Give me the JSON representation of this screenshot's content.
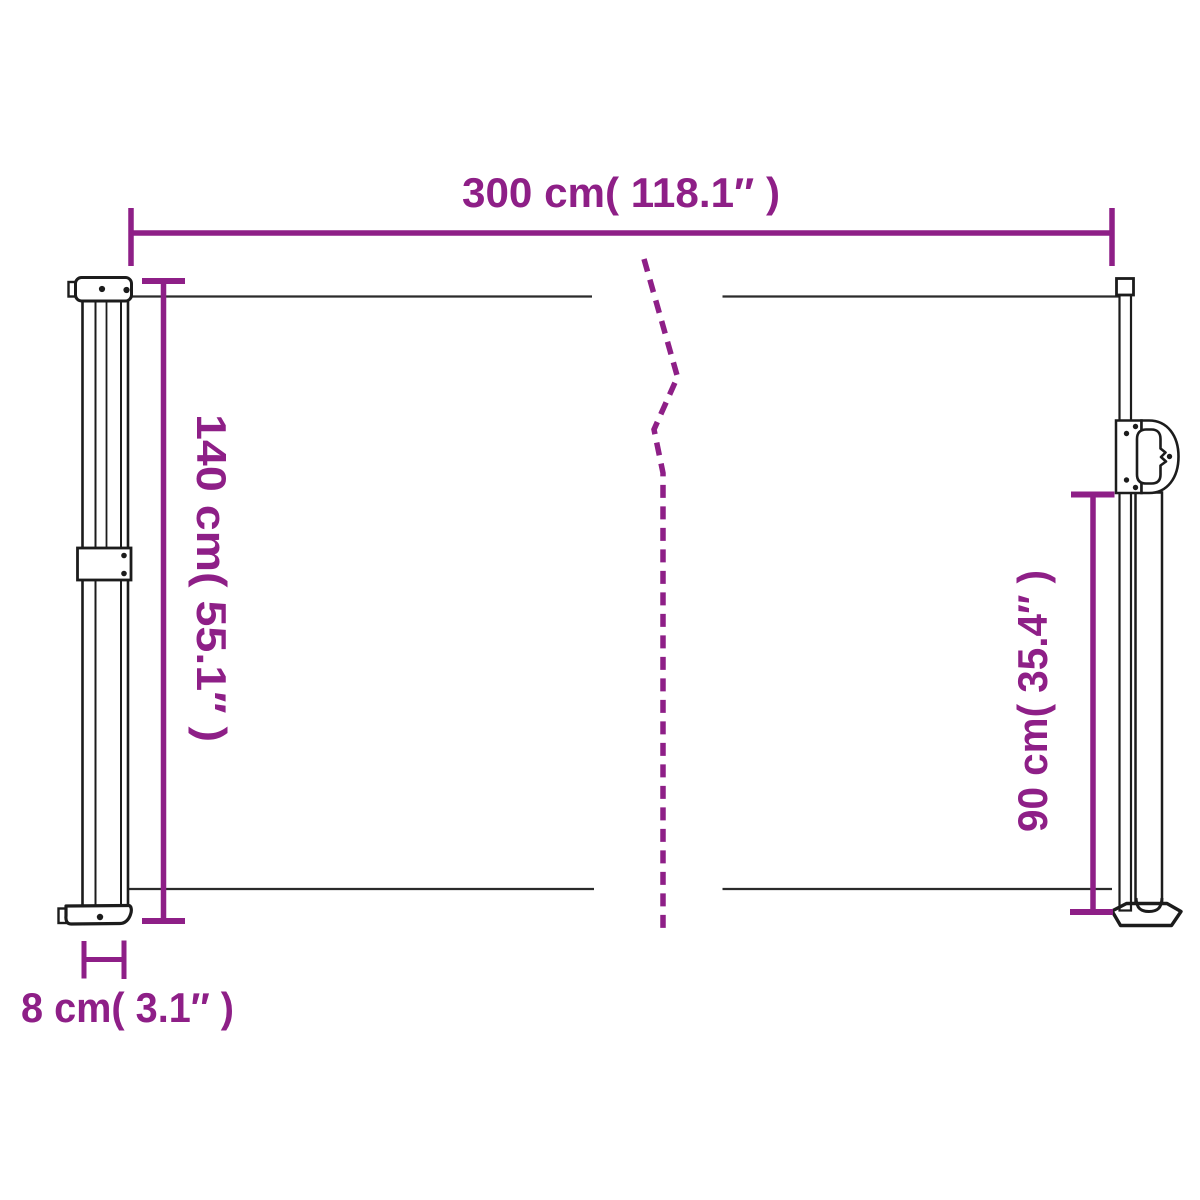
{
  "diagram": {
    "labels": {
      "width": "300 cm( 118.1″ )",
      "height_left": "140 cm( 55.1″ )",
      "height_right": "90 cm( 35.4″ )",
      "depth": "8 cm( 3.1″ )"
    },
    "colors": {
      "dimension_accent": "#8E1F87",
      "structure_outline": "#1C1C1C",
      "fabric_line": "#2B2B2B",
      "background": "#FFFFFF"
    }
  }
}
